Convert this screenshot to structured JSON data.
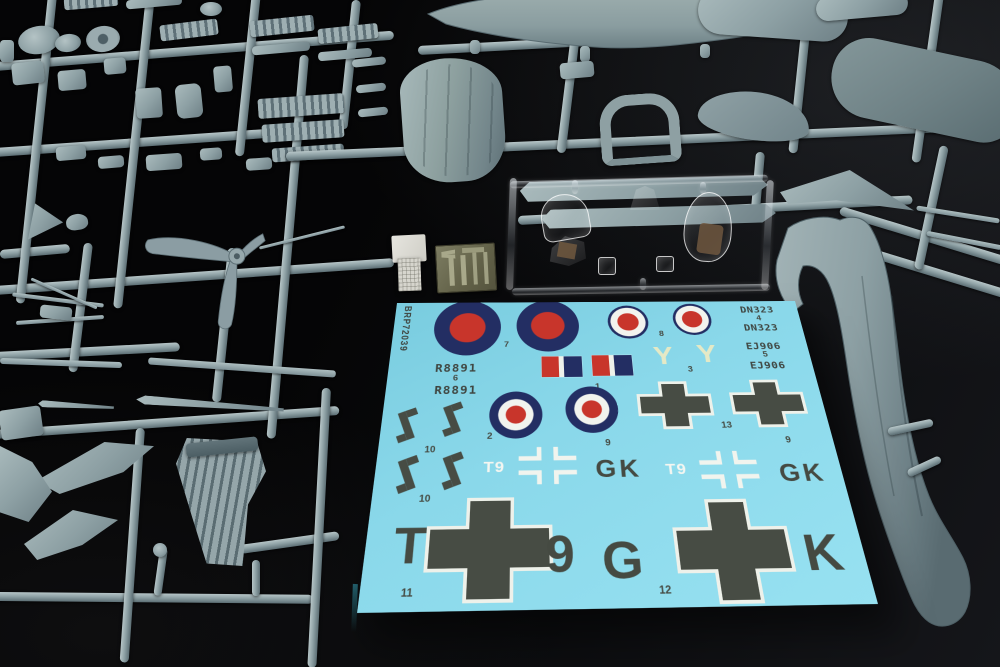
{
  "decal_sheet": {
    "product_code": "BRP72039",
    "sheet_color": "#87d7e9",
    "ink_dark": "#454a42",
    "roundel_navy": "#232e63",
    "roundel_red": "#c8352b",
    "roundel_yellow": "#dcc73c",
    "pale_yellow": "#e4e9c6",
    "markings": {
      "serial_dn323": "DN323",
      "serial_ej906": "EJ906",
      "serial_r8891": "R8891",
      "letter_y": "Y",
      "code_t9": "T9",
      "code_gk": "GK",
      "fuselage_t": "T",
      "fuselage_9": "9",
      "fuselage_g": "G",
      "fuselage_k": "K"
    },
    "numbers": {
      "n1": "1",
      "n2": "2",
      "n3": "3",
      "n4": "4",
      "n5": "5",
      "n6": "6",
      "n7": "7",
      "n8": "8",
      "n9": "9",
      "n10": "10",
      "n11": "11",
      "n12": "12",
      "n13": "13"
    }
  }
}
